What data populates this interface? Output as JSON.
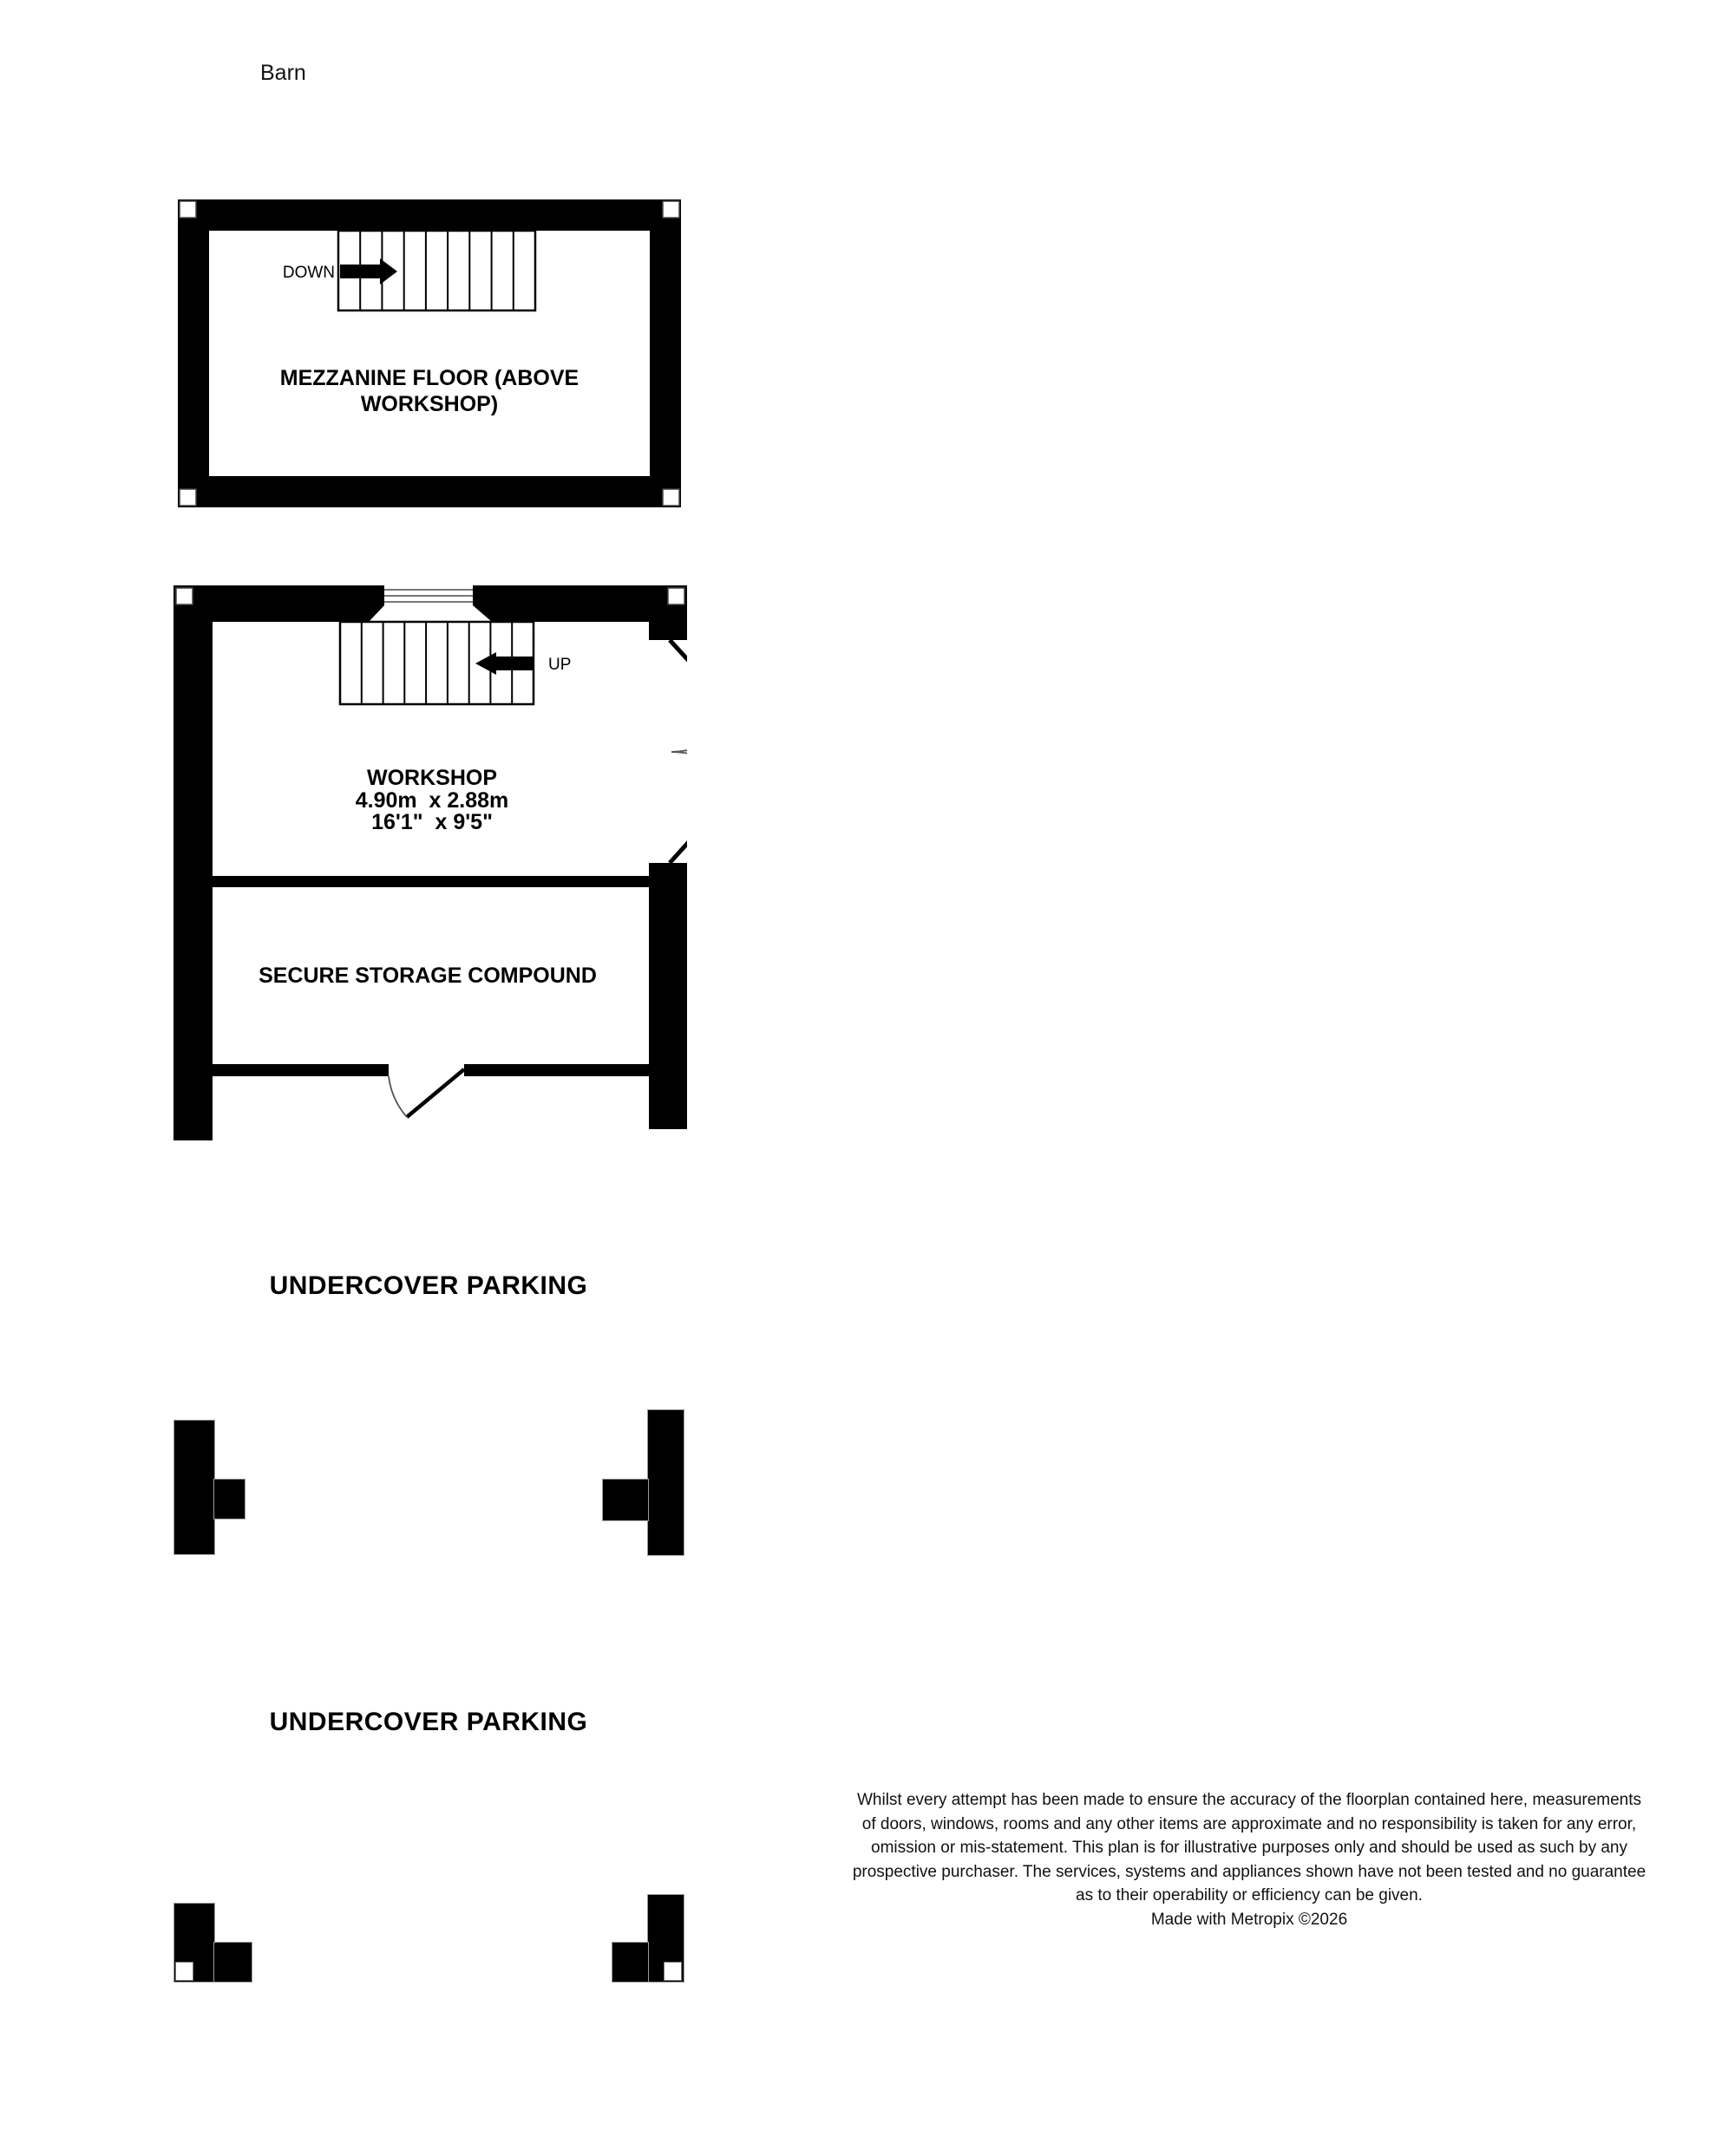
{
  "page": {
    "title": "Barn"
  },
  "mezzanine": {
    "room_label_line1": "MEZZANINE FLOOR (ABOVE",
    "room_label_line2": "WORKSHOP)",
    "stair_direction": "DOWN"
  },
  "ground_floor": {
    "workshop": {
      "name": "WORKSHOP",
      "dims_metric": "4.90m  x 2.88m",
      "dims_imperial": "16'1\"  x 9'5\""
    },
    "stair_direction": "UP",
    "storage": {
      "name": "SECURE STORAGE COMPOUND"
    }
  },
  "parking": {
    "area1": "UNDERCOVER PARKING",
    "area2": "UNDERCOVER PARKING"
  },
  "disclaimer": "Whilst every attempt has been made to ensure the accuracy of the floorplan contained here, measurements\nof doors, windows, rooms and any other items are approximate and no responsibility is taken for any error,\nomission or mis-statement. This plan is for illustrative purposes only and should be used as such by any\nprospective purchaser. The services, systems and appliances shown have not been tested and no guarantee\nas to their operability or efficiency can be given.\nMade with Metropix ©2026",
  "colors": {
    "wall": "#000000",
    "background": "#ffffff",
    "door_arc": "#555555",
    "stair_line": "#000000"
  }
}
